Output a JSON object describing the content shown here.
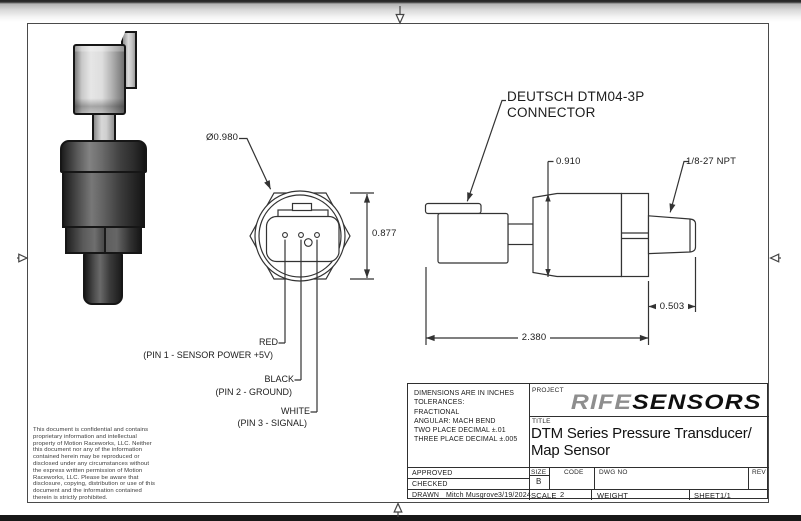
{
  "colors": {
    "line": "#333333",
    "frame": "#4a4a4a",
    "brand_gray": "#8e8e8e",
    "brand_black": "#0f0f0f"
  },
  "views": {
    "front": {
      "diameter": "Ø0.980",
      "height": "0.877",
      "pins": [
        {
          "wire": "RED",
          "desc": "(PIN 1 - SENSOR POWER +5V)"
        },
        {
          "wire": "BLACK",
          "desc": "(PIN 2 - GROUND)"
        },
        {
          "wire": "WHITE",
          "desc": "(PIN 3 - SIGNAL)"
        }
      ]
    },
    "side": {
      "callout_line1": "DEUTSCH DTM04-3P",
      "callout_line2": "CONNECTOR",
      "body_height": "0.910",
      "thread": "1/8-27 NPT",
      "thread_length": "0.503",
      "overall_length": "2.380"
    }
  },
  "note": "This document is confidential and contains proprietary information and intellectual property of Motion Raceworks, LLC. Neither this document nor any of the information contained herein may be reproduced or disclosed under any circumstances without the express written permission of Motion Raceworks, LLC. Please be aware that disclosure, copying, distribution or use of this document and the information contained therein is strictly prohibited.",
  "title_block": {
    "tolerances": [
      "DIMENSIONS ARE IN INCHES",
      "TOLERANCES:",
      "FRACTIONAL",
      "ANGULAR: MACH BEND",
      "TWO PLACE DECIMAL ±.01",
      "THREE PLACE DECIMAL ±.005"
    ],
    "project_label": "PROJECT",
    "brand_part1": "RIFE",
    "brand_part2": "SENSORS",
    "title_label": "TITLE",
    "title_line1": "DTM Series Pressure Transducer/",
    "title_line2": "Map Sensor",
    "approved_label": "APPROVED",
    "checked_label": "CHECKED",
    "drawn_label": "DRAWN",
    "drawn_by": "Mitch Musgrove",
    "drawn_date": "3/19/2024",
    "size_label": "SIZE",
    "size_value": "B",
    "code_label": "CODE",
    "dwg_label": "DWG NO",
    "rev_label": "REV",
    "scale_label": "SCALE",
    "scale_value": "2",
    "weight_label": "WEIGHT",
    "sheet_label": "SHEET",
    "sheet_value": "1/1"
  }
}
